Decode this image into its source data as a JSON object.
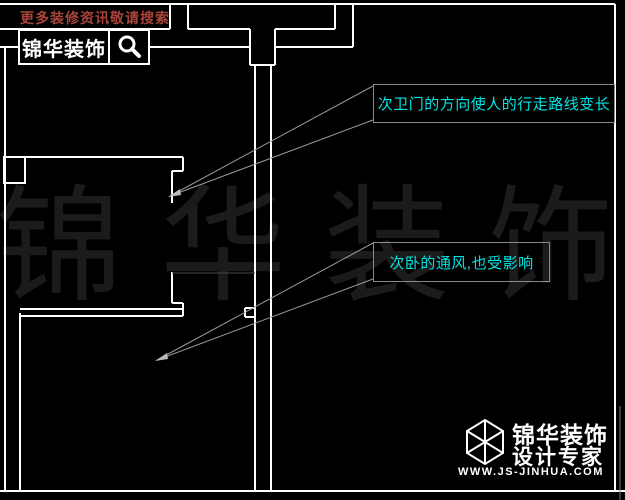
{
  "colors": {
    "background": "#000000",
    "wall_line": "#ffffff",
    "leader_line": "#9a9a9a",
    "annotation_text": "#00e5e5",
    "annotation_border": "#8a8a8a",
    "search_hint_text": "#a8443a",
    "watermark_text": "#1b1b1b"
  },
  "search_banner": {
    "hint": "更多装修资讯敬请搜索",
    "brand": "锦华装饰",
    "icon": "magnifier-icon"
  },
  "annotations": [
    {
      "text": "次卫门的方向使人的行走路线变长"
    },
    {
      "text": "次卧的通风,也受影响"
    }
  ],
  "watermark": {
    "text": "锦华装饰"
  },
  "footer_logo": {
    "brand": "锦华装饰",
    "tagline": "设计专家",
    "website": "WWW.JS-JINHUA.COM",
    "icon": "cube-logo-icon"
  }
}
